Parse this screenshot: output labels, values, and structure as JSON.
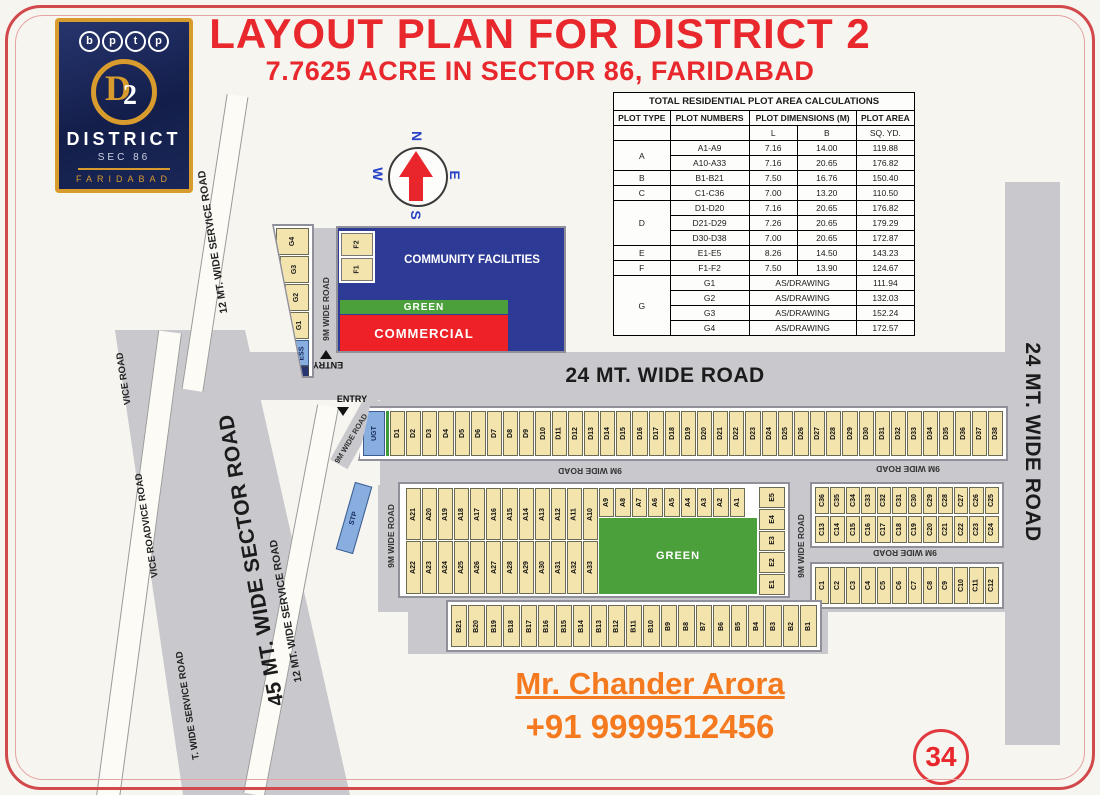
{
  "page": {
    "title_line1": "LAYOUT PLAN FOR DISTRICT 2",
    "title_line2": "7.7625 ACRE IN SECTOR 86, FARIDABAD",
    "badge_number": "34"
  },
  "logo": {
    "brand_letters": [
      "b",
      "p",
      "t",
      "p"
    ],
    "emblem_d": "D",
    "emblem_2": "2",
    "name": "DISTRICT",
    "sector": "SEC 86",
    "city": "FARIDABAD"
  },
  "compass": {
    "n": "N",
    "e": "E",
    "s": "S",
    "w": "W"
  },
  "table": {
    "title": "TOTAL RESIDENTIAL PLOT AREA CALCULATIONS",
    "col_plot_type": "PLOT TYPE",
    "col_plot_numbers": "PLOT  NUMBERS",
    "col_dimensions": "PLOT DIMENSIONS (M)",
    "col_plot_area": "PLOT AREA",
    "sub_l": "L",
    "sub_b": "B",
    "sub_area": "SQ. YD.",
    "rows": [
      {
        "type": "A",
        "rowspan": 2,
        "numbers": "A1-A9",
        "l": "7.16",
        "b": "14.00",
        "area": "119.88"
      },
      {
        "numbers": "A10-A33",
        "l": "7.16",
        "b": "20.65",
        "area": "176.82"
      },
      {
        "type": "B",
        "rowspan": 1,
        "numbers": "B1-B21",
        "l": "7.50",
        "b": "16.76",
        "area": "150.40"
      },
      {
        "type": "C",
        "rowspan": 1,
        "numbers": "C1-C36",
        "l": "7.00",
        "b": "13.20",
        "area": "110.50"
      },
      {
        "type": "D",
        "rowspan": 3,
        "numbers": "D1-D20",
        "l": "7.16",
        "b": "20.65",
        "area": "176.82"
      },
      {
        "numbers": "D21-D29",
        "l": "7.26",
        "b": "20.65",
        "area": "179.29"
      },
      {
        "numbers": "D30-D38",
        "l": "7.00",
        "b": "20.65",
        "area": "172.87"
      },
      {
        "type": "E",
        "rowspan": 1,
        "numbers": "E1-E5",
        "l": "8.26",
        "b": "14.50",
        "area": "143.23"
      },
      {
        "type": "F",
        "rowspan": 1,
        "numbers": "F1-F2",
        "l": "7.50",
        "b": "13.90",
        "area": "124.67"
      },
      {
        "type": "G",
        "rowspan": 4,
        "numbers": "G1",
        "dims": "AS/DRAWING",
        "area": "111.94"
      },
      {
        "numbers": "G2",
        "dims": "AS/DRAWING",
        "area": "132.03"
      },
      {
        "numbers": "G3",
        "dims": "AS/DRAWING",
        "area": "152.24"
      },
      {
        "numbers": "G4",
        "dims": "AS/DRAWING",
        "area": "172.57"
      }
    ]
  },
  "map": {
    "roads": {
      "wide24": "24 MT. WIDE ROAD",
      "sector45": "45 MT. WIDE SECTOR ROAD",
      "service12": "12 MT. WIDE SERVICE ROAD",
      "wide9": "9M WIDE ROAD",
      "strip_segments": [
        "VICE ROAD",
        "VICE ROADVICE ROAD",
        "T. WIDE SERVICE ROAD"
      ]
    },
    "entry": "ENTRY",
    "zones": {
      "community": "COMMUNITY FACILITIES",
      "green": "GREEN",
      "commercial": "COMMERCIAL",
      "green_big": "GREEN"
    },
    "special_plots": [
      "UGT",
      "STP",
      "ESS"
    ],
    "plots": {
      "ugt": "UGT",
      "stp": "STP",
      "g_wedge": [
        "G4",
        "G3",
        "G2",
        "G1",
        "ESS"
      ],
      "f_plots": [
        "F2",
        "F1"
      ],
      "d_row": [
        "D1",
        "D2",
        "D3",
        "D4",
        "D5",
        "D6",
        "D7",
        "D8",
        "D9",
        "D10",
        "D11",
        "D12",
        "D13",
        "D14",
        "D15",
        "D16",
        "D17",
        "D18",
        "D19",
        "D20",
        "D21",
        "D22",
        "D23",
        "D24",
        "D25",
        "D26",
        "D27",
        "D28",
        "D29",
        "D30",
        "D31",
        "D32",
        "D33",
        "D34",
        "D35",
        "D36",
        "D37",
        "D38"
      ],
      "a_top": [
        "A21",
        "A20",
        "A19",
        "A18",
        "A17",
        "A16",
        "A15",
        "A14",
        "A13",
        "A12",
        "A11",
        "A10"
      ],
      "a_short": [
        "A9",
        "A8",
        "A7",
        "A6",
        "A5",
        "A4",
        "A3",
        "A2",
        "A1"
      ],
      "a_bottom": [
        "A22",
        "A23",
        "A24",
        "A25",
        "A26",
        "A27",
        "A28",
        "A29",
        "A30",
        "A31",
        "A32",
        "A33"
      ],
      "e_col": [
        "E5",
        "E4",
        "E3",
        "E2",
        "E1"
      ],
      "c_top": [
        "C36",
        "C35",
        "C34",
        "C33",
        "C32",
        "C31",
        "C30",
        "C29",
        "C28",
        "C27",
        "C26",
        "C25"
      ],
      "c_mid": [
        "C13",
        "C14",
        "C15",
        "C16",
        "C17",
        "C18",
        "C19",
        "C20",
        "C21",
        "C22",
        "C23",
        "C24"
      ],
      "c_bottom": [
        "C1",
        "C2",
        "C3",
        "C4",
        "C5",
        "C6",
        "C7",
        "C8",
        "C9",
        "C10",
        "C11",
        "C12"
      ],
      "b_row": [
        "B21",
        "B20",
        "B19",
        "B18",
        "B17",
        "B16",
        "B15",
        "B14",
        "B13",
        "B12",
        "B11",
        "B10",
        "B9",
        "B8",
        "B7",
        "B6",
        "B5",
        "B4",
        "B3",
        "B2",
        "B1"
      ]
    }
  },
  "contact": {
    "name": "Mr. Chander Arora",
    "phone": "+91 9999512456"
  },
  "colors": {
    "title_red": "#e8282d",
    "contact_orange": "#f5791f",
    "road_gray": "#c9c8cd",
    "plot_tan": "#f3e3ad",
    "plot_blue": "#87aede",
    "community_navy": "#2e3b96",
    "green": "#4ba03c",
    "commercial_red": "#ee2226",
    "logo_navy": "#131e4a",
    "logo_gold": "#d89b2e"
  }
}
